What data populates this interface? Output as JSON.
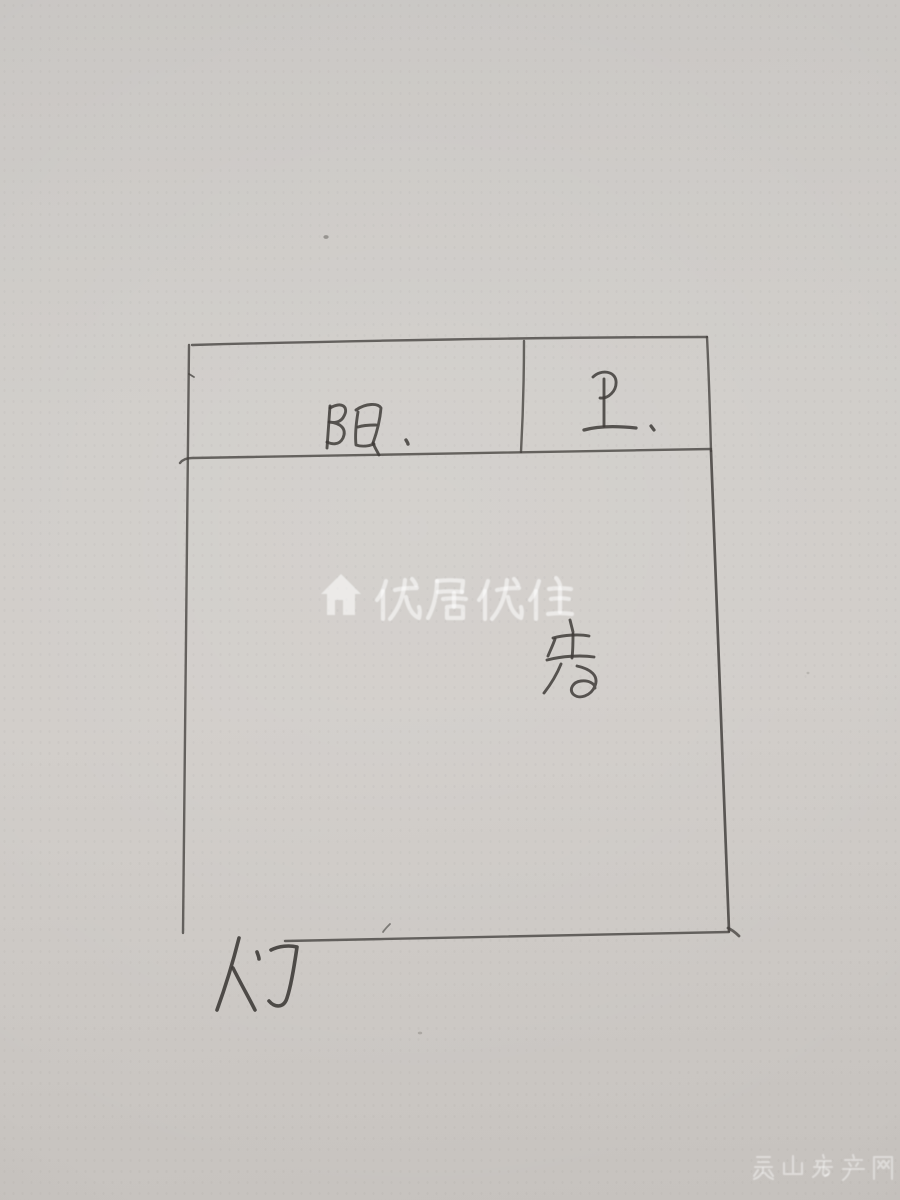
{
  "photo": {
    "kind": "hand-drawn floor plan sketch on paper",
    "paper_color": "#cdc9c5",
    "pencil_color": "#45423f"
  },
  "floorplan": {
    "rooms": [
      {
        "id": "balcony",
        "label": "阳"
      },
      {
        "id": "bathroom",
        "label": "卫"
      },
      {
        "id": "bedroom",
        "label": "房"
      }
    ],
    "door_label": "门"
  },
  "watermarks": {
    "center": {
      "icon": "house-icon",
      "text": "优居优住",
      "color": "rgba(255,255,255,0.55)"
    },
    "bottom_right": {
      "text": "灵山房产网",
      "color": "rgba(255,255,255,0.42)"
    }
  }
}
